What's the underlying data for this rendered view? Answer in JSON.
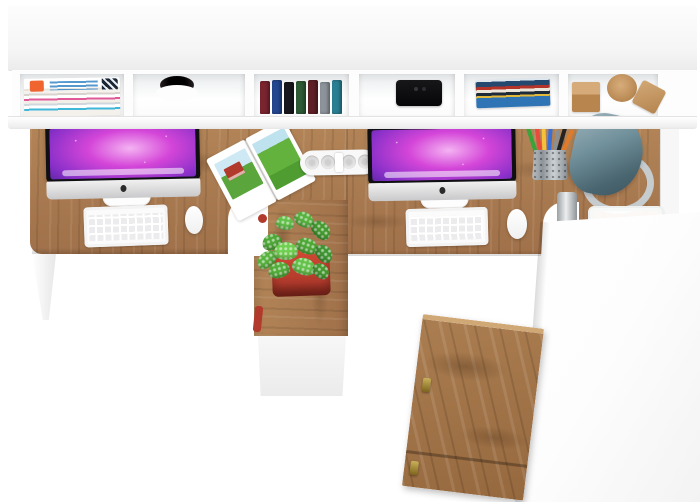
{
  "meta": {
    "title": "Two-person white office desk with hutch and oak worktop — top view product render",
    "canvas": {
      "width": 700,
      "height": 502
    },
    "view": "top-down"
  },
  "palette": {
    "background": "#ffffff",
    "furniture_white": "#fdfdfd",
    "shadow_gray": "#e8e8e8",
    "wood": "#a0714a",
    "wood_light": "#b28457",
    "wood_dark": "#6b4a2e",
    "accent_red": "#b13a2c",
    "plant_green": "#57b33e",
    "lamp_teal": "#49656f",
    "chrome": "#c6cbce",
    "bezel_black": "#101014",
    "wallpaper_purple": "#d445d8"
  },
  "items": {
    "hutch": {
      "label": "White wall hutch with six open cubbies"
    },
    "magazine_stack": {
      "label": "Stack of magazines in left cubby"
    },
    "cable_hole": {
      "label": "Cable grommet hole in hutch top"
    },
    "shelf_books": {
      "label": "Row of upright books",
      "styles": [
        "background:#7a2430",
        "background:#24468e",
        "background:#17171c",
        "background:#2e5a36",
        "background:#5e2026",
        "background:#8d939a",
        "background:#2b7f93"
      ]
    },
    "speaker": {
      "label": "Black speaker in cubby"
    },
    "book_stack": {
      "label": "Horizontal stack of books"
    },
    "decor_blocks": {
      "label": "Wooden decor blocks: cube, cylinder, wedge"
    },
    "desk": {
      "label": "Oak double desktop with center seam"
    },
    "imac_left": {
      "label": "iMac with purple galaxy wallpaper (left workstation)"
    },
    "imac_right": {
      "label": "iMac with purple galaxy wallpaper (right workstation)"
    },
    "keyboard_left": {
      "label": "White keyboard (left)"
    },
    "keyboard_right": {
      "label": "White keyboard (right)"
    },
    "mouse_left": {
      "label": "White mouse (left)"
    },
    "mouse_right": {
      "label": "White mouse (right)"
    },
    "open_magazine": {
      "label": "Open magazine with red barn landscape photos"
    },
    "power_strip": {
      "label": "White power strip with four round sockets"
    },
    "pencil_cup": {
      "label": "Mesh cup with colored pencils",
      "styles": [
        "background:#3aa33a",
        "background:#e74c3c",
        "background:#f4c23a",
        "background:#3a6fd8",
        "background:#8a8f94",
        "background:#232323",
        "background:#e07b2a"
      ]
    },
    "desk_lamp": {
      "label": "Slate-teal cone desk lamp with chrome ring base"
    },
    "paper_tray": {
      "label": "White paper tray at desk edge"
    },
    "plant": {
      "label": "Green fittonia plant in red square pot"
    },
    "pedestal": {
      "label": "Oak return pedestal with white front"
    },
    "drawer_cabinet": {
      "label": "White cabinet with oak door fronts and brass keys"
    },
    "desk_leg_left": {
      "label": "White tapered desk leg"
    },
    "desk_leg_chrome": {
      "label": "Chrome desk leg"
    }
  }
}
